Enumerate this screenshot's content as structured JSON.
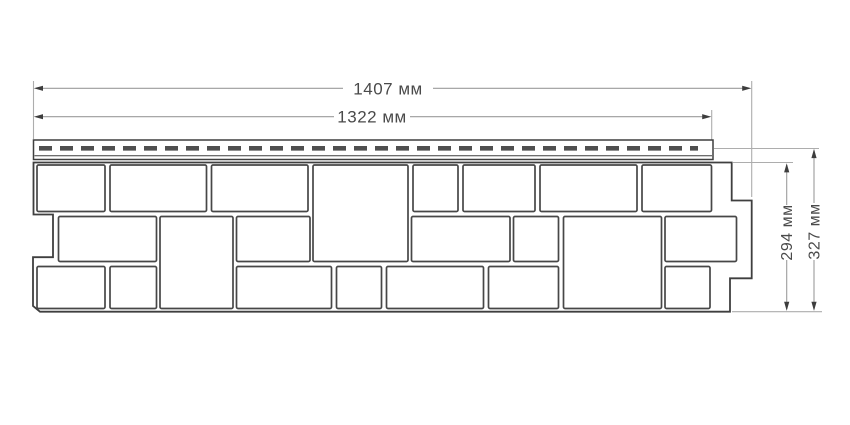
{
  "drawing": {
    "dimensions": {
      "width_full": {
        "value": "1407",
        "unit": "мм",
        "label": "1407 мм"
      },
      "width_face": {
        "value": "1322",
        "unit": "мм",
        "label": "1322 мм"
      },
      "height_face": {
        "value": "294",
        "unit": "мм",
        "label": "294 мм"
      },
      "height_full": {
        "value": "327",
        "unit": "мм",
        "label": "327 мм"
      }
    },
    "colors": {
      "background": "#ffffff",
      "panel_outline": "#3f3f3f",
      "block_outline": "#474747",
      "perforation_slots": "#4f4f4f",
      "dimension_line": "#9c9c9c",
      "extension_line": "#adadad",
      "arrowhead": "#3d3d3d",
      "text": "#4a4a4a"
    }
  }
}
